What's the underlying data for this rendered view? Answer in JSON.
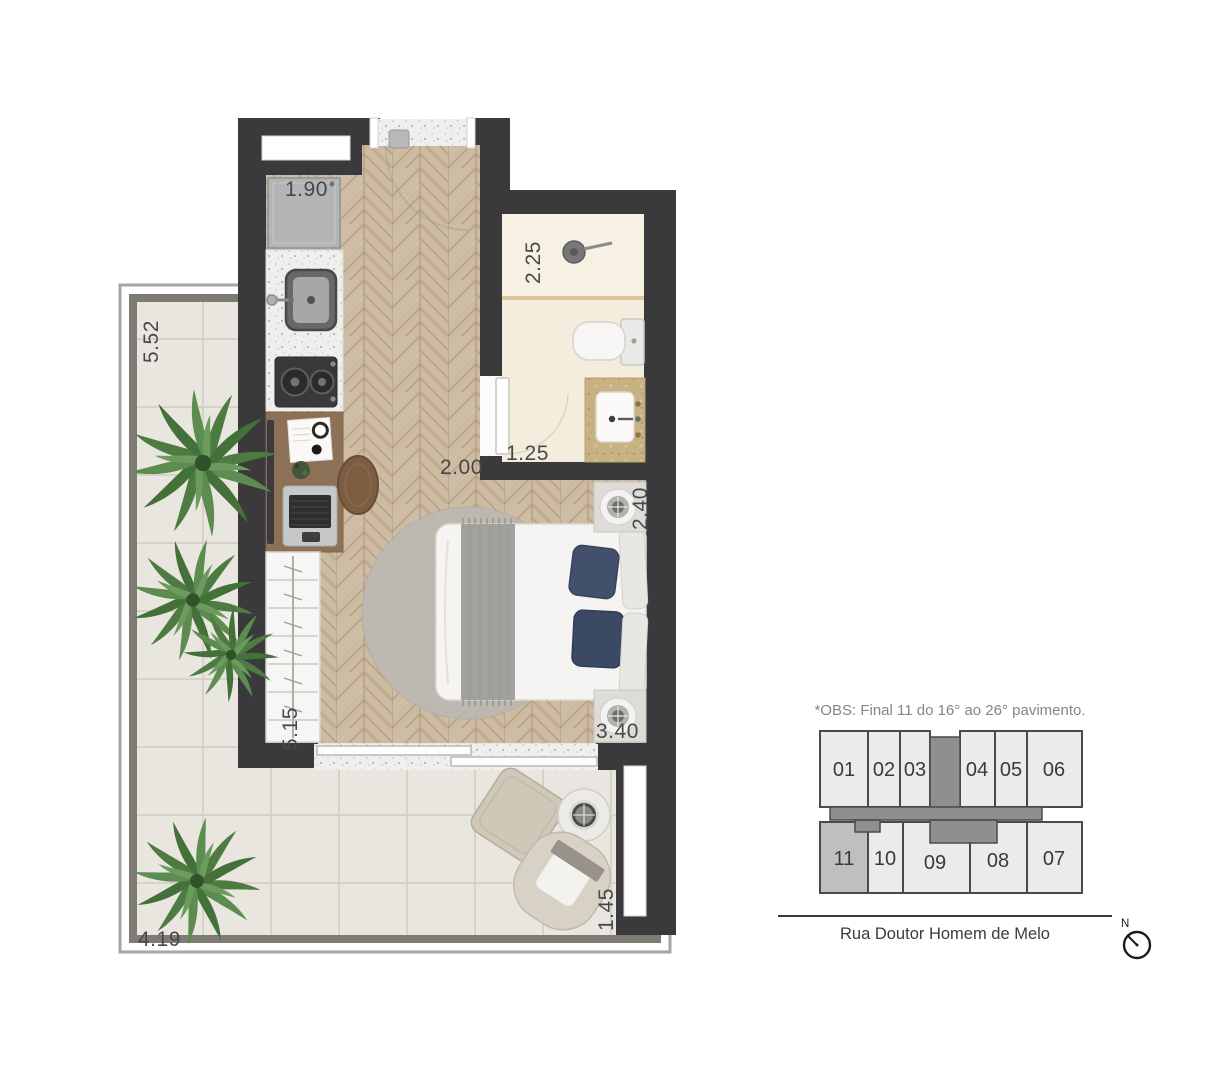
{
  "floor_plan": {
    "dimensions": {
      "kitchen": "1.90",
      "bathroom_length": "2.25",
      "terrace_left": "5.52",
      "bathroom_width": "1.25",
      "studio_width": "2.00",
      "bed_recess_top": "2.40",
      "wardrobe_wall": "5.15",
      "bed_recess_bottom": "3.40",
      "terrace_bottom": "4.19",
      "terrace_right_end": "1.45"
    }
  },
  "key_plan": {
    "note": "*OBS: Final 11 do 16° ao 26° pavimento.",
    "units_top": [
      "01",
      "02",
      "03",
      "04",
      "05",
      "06"
    ],
    "units_bottom": [
      "11",
      "10",
      "09",
      "08",
      "07"
    ],
    "highlighted_unit": "11",
    "street": "Rua Doutor Homem de Melo",
    "north_label": "N"
  },
  "colors": {
    "wall": "#3a3a3c",
    "wood_floor": "#cdbba3",
    "terrace_floor": "#e9e6e0",
    "bathroom_floor": "#f3ebdc",
    "vanity_granite": "#c8b284",
    "pillow_navy": "#3f4d69",
    "plant_green": "#4e7b42",
    "unit_fill": "#ebebeb",
    "unit_highlight": "#bfbfbf",
    "core_fill": "#8f8f8f"
  }
}
